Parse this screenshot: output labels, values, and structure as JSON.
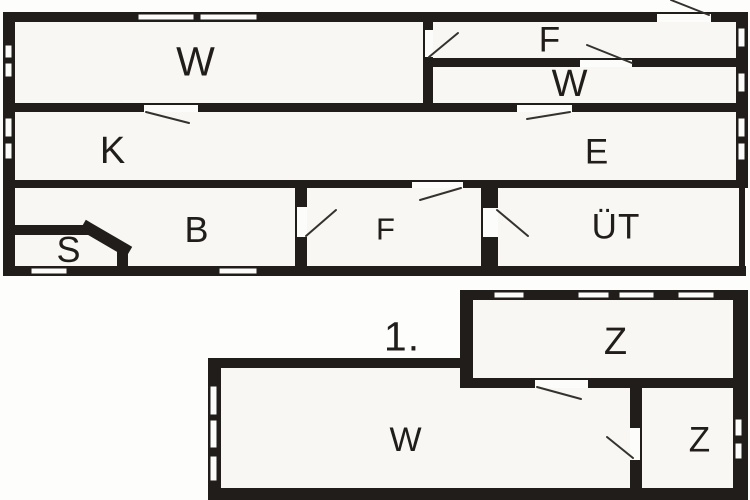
{
  "plan": {
    "title": "floor-plan",
    "colors": {
      "wall": "#201d1a",
      "room_fill": "#f8f7f3",
      "background": "#fdfdfc",
      "swing_line": "#35322e",
      "window_fill": "#fcfcfa"
    },
    "floors": {
      "upper_rooms": [
        "W",
        "F",
        "W",
        "K",
        "E",
        "B",
        "S",
        "F",
        "ÜT"
      ],
      "lower_label": "1.",
      "lower_rooms": [
        "Z",
        "W",
        "Z"
      ]
    },
    "labels": [
      {
        "text": "W",
        "x": 196,
        "y": 62,
        "size": 41
      },
      {
        "text": "F",
        "x": 550,
        "y": 40,
        "size": 35
      },
      {
        "text": "W",
        "x": 570,
        "y": 84,
        "size": 38
      },
      {
        "text": "K",
        "x": 113,
        "y": 151,
        "size": 38
      },
      {
        "text": "E",
        "x": 597,
        "y": 152,
        "size": 35
      },
      {
        "text": "B",
        "x": 197,
        "y": 230,
        "size": 36
      },
      {
        "text": "S",
        "x": 69,
        "y": 250,
        "size": 36
      },
      {
        "text": "F",
        "x": 386,
        "y": 229,
        "size": 31
      },
      {
        "text": "ÜT",
        "x": 616,
        "y": 227,
        "size": 35
      },
      {
        "text": "1.",
        "x": 402,
        "y": 337,
        "size": 41
      },
      {
        "text": "Z",
        "x": 616,
        "y": 342,
        "size": 38
      },
      {
        "text": "W",
        "x": 406,
        "y": 440,
        "size": 34
      },
      {
        "text": "Z",
        "x": 700,
        "y": 440,
        "size": 35
      }
    ],
    "room_fills": [
      [
        15,
        22,
        724,
        244
      ],
      [
        473,
        300,
        260,
        78
      ],
      [
        221,
        368,
        409,
        120
      ],
      [
        642,
        388,
        91,
        100
      ]
    ],
    "walls": [
      [
        3,
        12,
        745,
        10
      ],
      [
        3,
        12,
        12,
        264
      ],
      [
        736,
        12,
        12,
        174
      ],
      [
        3,
        266,
        743,
        10
      ],
      [
        739,
        184,
        6,
        84
      ],
      [
        15,
        103,
        721,
        9
      ],
      [
        433,
        58,
        303,
        9
      ],
      [
        3,
        180,
        745,
        8
      ],
      [
        423,
        22,
        10,
        81
      ],
      [
        295,
        188,
        12,
        78
      ],
      [
        481,
        188,
        17,
        78
      ],
      [
        15,
        225,
        76,
        10
      ],
      [
        117,
        246,
        11,
        20
      ],
      [
        460,
        290,
        288,
        10
      ],
      [
        460,
        290,
        13,
        98
      ],
      [
        460,
        378,
        273,
        10
      ],
      [
        733,
        290,
        15,
        210
      ],
      [
        208,
        358,
        265,
        10
      ],
      [
        208,
        358,
        13,
        142
      ],
      [
        208,
        488,
        540,
        12
      ],
      [
        630,
        378,
        12,
        122
      ]
    ],
    "chamfers": [
      [
        88,
        228,
        124,
        249,
        12
      ]
    ],
    "windows": [
      [
        137,
        13,
        58,
        8
      ],
      [
        199,
        13,
        59,
        8
      ],
      [
        4,
        44,
        9,
        15
      ],
      [
        4,
        62,
        9,
        16
      ],
      [
        4,
        117,
        9,
        21
      ],
      [
        4,
        142,
        9,
        18
      ],
      [
        737,
        27,
        9,
        21
      ],
      [
        737,
        72,
        9,
        21
      ],
      [
        737,
        117,
        9,
        21
      ],
      [
        737,
        142,
        9,
        19
      ],
      [
        30,
        267,
        38,
        8
      ],
      [
        218,
        267,
        40,
        8
      ],
      [
        493,
        291,
        32,
        8
      ],
      [
        577,
        291,
        33,
        8
      ],
      [
        618,
        291,
        37,
        8
      ],
      [
        677,
        291,
        38,
        8
      ],
      [
        734,
        418,
        9,
        19
      ],
      [
        734,
        442,
        9,
        18
      ],
      [
        209,
        385,
        9,
        31
      ],
      [
        209,
        419,
        9,
        30
      ],
      [
        209,
        455,
        9,
        27
      ]
    ],
    "door_gaps": [
      [
        657,
        12,
        54,
        10,
        "top"
      ],
      [
        144,
        103,
        54,
        9,
        "top"
      ],
      [
        517,
        103,
        55,
        9,
        "top"
      ],
      [
        423,
        30,
        10,
        27,
        "left"
      ],
      [
        580,
        58,
        52,
        9,
        "top"
      ],
      [
        412,
        180,
        51,
        8,
        "top"
      ],
      [
        295,
        207,
        12,
        30,
        "left"
      ],
      [
        481,
        208,
        17,
        29,
        "left"
      ],
      [
        535,
        378,
        53,
        10,
        "top"
      ],
      [
        630,
        428,
        12,
        32,
        "right"
      ]
    ],
    "door_swings": [
      [
        671,
        0,
        709,
        15
      ],
      [
        146,
        112,
        189,
        123
      ],
      [
        570,
        112,
        527,
        119
      ],
      [
        429,
        57,
        458,
        33
      ],
      [
        632,
        63,
        587,
        45
      ],
      [
        461,
        188,
        420,
        200
      ],
      [
        306,
        236,
        336,
        210
      ],
      [
        497,
        210,
        528,
        236
      ],
      [
        537,
        387,
        581,
        399
      ],
      [
        633,
        458,
        607,
        437
      ]
    ]
  }
}
